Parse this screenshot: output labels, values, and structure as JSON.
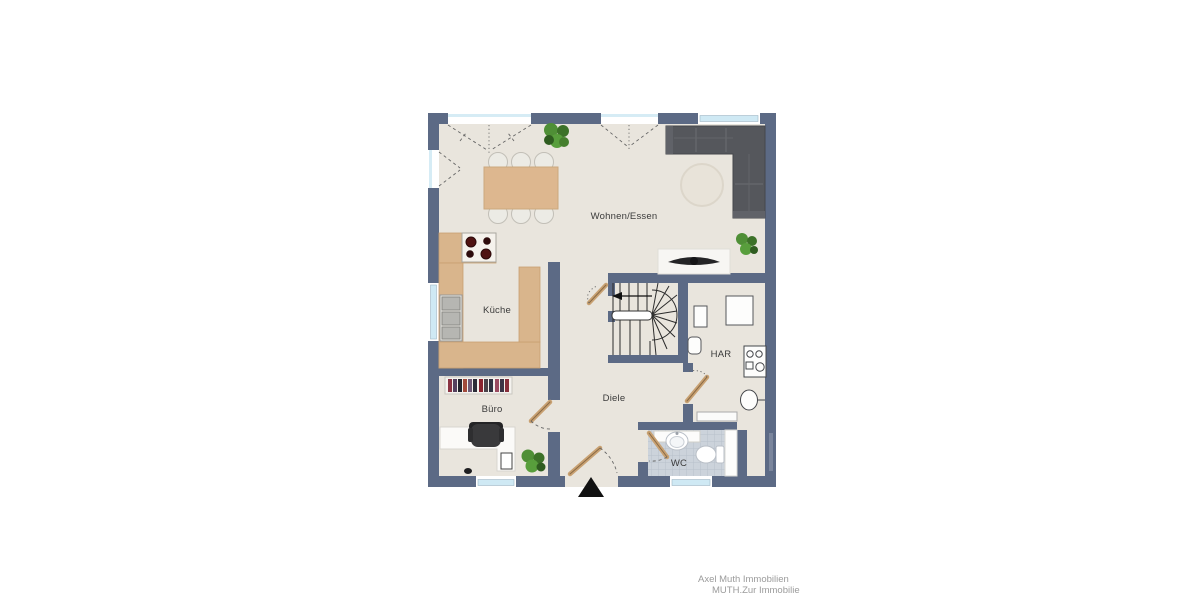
{
  "plan": {
    "type": "floorplan-ground-floor",
    "rooms": [
      {
        "name": "wohnen-essen",
        "label": "Wohnen/Essen"
      },
      {
        "name": "kueche",
        "label": "Küche"
      },
      {
        "name": "buero",
        "label": "Büro"
      },
      {
        "name": "diele",
        "label": "Diele"
      },
      {
        "name": "har",
        "label": "HAR"
      },
      {
        "name": "wc",
        "label": "WC"
      }
    ]
  },
  "watermark": {
    "line1": "Axel Muth Immobilien",
    "line2": "MUTH.Zur Immobilie"
  },
  "colors": {
    "wall": "#5c6a85",
    "floor": "#e9e5dd",
    "counter_wood": "#d9b58c",
    "door_wood": "#c8a172",
    "sofa": "#55575c",
    "window_glass": "#cfe9f4",
    "wc_tile": "#ccd3db",
    "plant_green": "#4f8f36",
    "watermark_text": "#9b9b9b"
  },
  "icons": [
    "entrance-direction-arrow",
    "staircase",
    "door-swing",
    "window",
    "corner-sofa",
    "tv-lowboard",
    "round-rug",
    "dining-table",
    "chair",
    "stove",
    "kitchen-sink",
    "bookshelf",
    "desk",
    "office-chair",
    "plant",
    "wardrobe",
    "washing-machine",
    "boiler",
    "wc-sink",
    "toilet",
    "radiator"
  ]
}
